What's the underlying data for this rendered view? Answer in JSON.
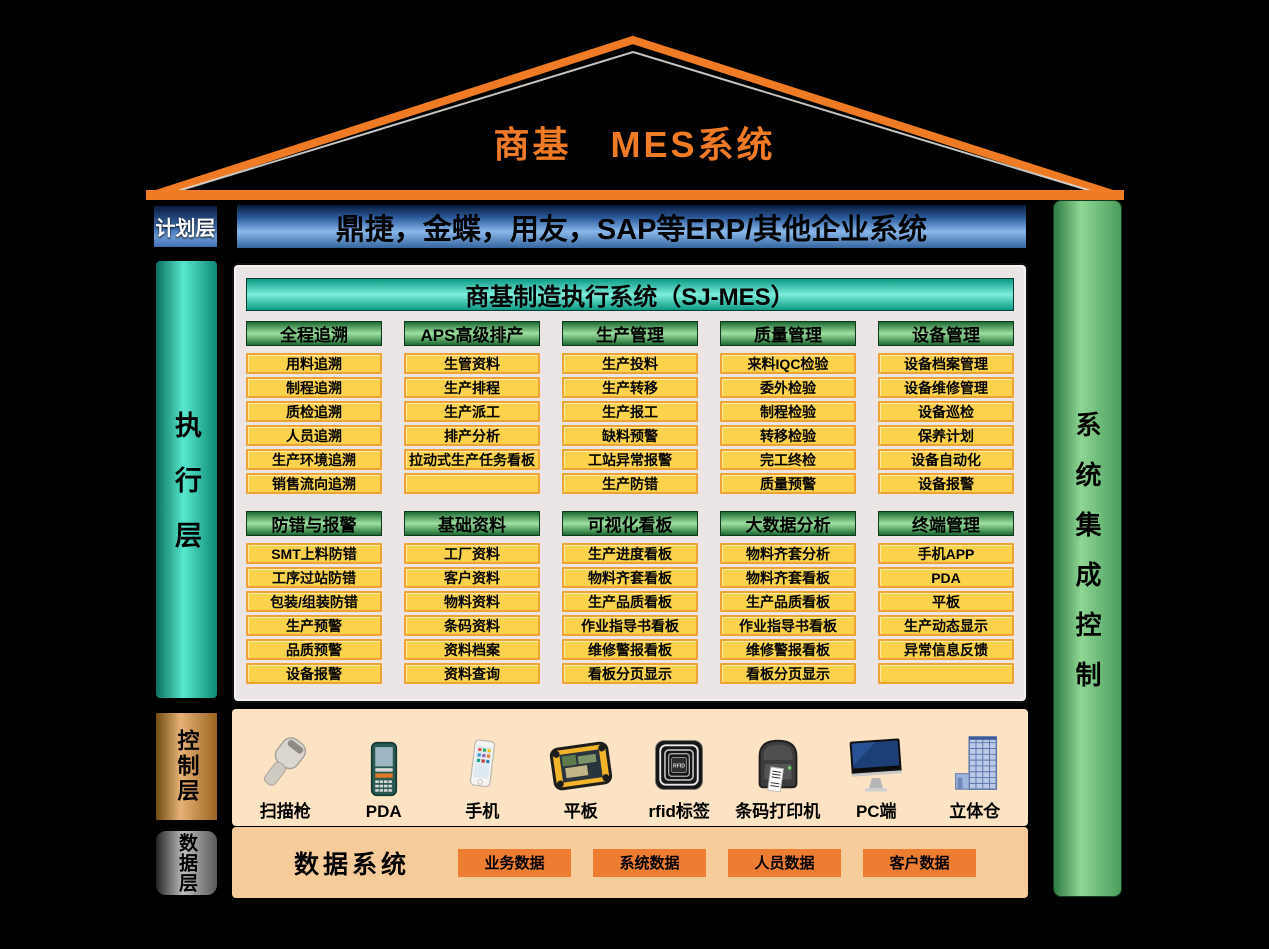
{
  "roof": {
    "title": "商基　MES系统"
  },
  "plan_layer": {
    "label": "计划层",
    "erp_bar": "鼎捷，金蝶，用友，SAP等ERP/其他企业系统"
  },
  "exec_layer": {
    "label": "执行层"
  },
  "control_layer": {
    "label": "控制层",
    "devices": [
      {
        "icon": "barcode-scanner-icon",
        "label": "扫描枪"
      },
      {
        "icon": "pda-icon",
        "label": "PDA"
      },
      {
        "icon": "phone-icon",
        "label": "手机"
      },
      {
        "icon": "tablet-icon",
        "label": "平板"
      },
      {
        "icon": "rfid-tag-icon",
        "label": "rfid标签"
      },
      {
        "icon": "barcode-printer-icon",
        "label": "条码打印机"
      },
      {
        "icon": "pc-monitor-icon",
        "label": "PC端"
      },
      {
        "icon": "warehouse-icon",
        "label": "立体仓"
      }
    ]
  },
  "data_layer": {
    "label": "数据层",
    "title": "数据系统",
    "boxes": [
      "业务数据",
      "系统数据",
      "人员数据",
      "客户数据"
    ]
  },
  "integration_bar": {
    "label": "系统集成控制"
  },
  "mes": {
    "header": "商基制造执行系统（SJ-MES）",
    "groups_row1": [
      {
        "title": "全程追溯",
        "items": [
          "用料追溯",
          "制程追溯",
          "质检追溯",
          "人员追溯",
          "生产环境追溯",
          "销售流向追溯"
        ]
      },
      {
        "title": "APS高级排产",
        "items": [
          "生管资料",
          "生产排程",
          "生产派工",
          "排产分析",
          "拉动式生产任务看板",
          ""
        ]
      },
      {
        "title": "生产管理",
        "items": [
          "生产投料",
          "生产转移",
          "生产报工",
          "缺料预警",
          "工站异常报警",
          "生产防错"
        ]
      },
      {
        "title": "质量管理",
        "items": [
          "来料IQC检验",
          "委外检验",
          "制程检验",
          "转移检验",
          "完工终检",
          "质量预警"
        ]
      },
      {
        "title": "设备管理",
        "items": [
          "设备档案管理",
          "设备维修管理",
          "设备巡检",
          "保养计划",
          "设备自动化",
          "设备报警"
        ]
      }
    ],
    "groups_row2": [
      {
        "title": "防错与报警",
        "items": [
          "SMT上料防错",
          "工序过站防错",
          "包装/组装防错",
          "生产预警",
          "品质预警",
          "设备报警"
        ]
      },
      {
        "title": "基础资料",
        "items": [
          "工厂资料",
          "客户资料",
          "物料资料",
          "条码资料",
          "资料档案",
          "资料查询"
        ]
      },
      {
        "title": "可视化看板",
        "items": [
          "生产进度看板",
          "物料齐套看板",
          "生产品质看板",
          "作业指导书看板",
          "维修警报看板",
          "看板分页显示"
        ]
      },
      {
        "title": "大数据分析",
        "items": [
          "物料齐套分析",
          "物料齐套看板",
          "生产品质看板",
          "作业指导书看板",
          "维修警报看板",
          "看板分页显示"
        ]
      },
      {
        "title": "终端管理",
        "items": [
          "手机APP",
          "PDA",
          "平板",
          "生产动态显示",
          "异常信息反馈",
          ""
        ]
      }
    ]
  },
  "colors": {
    "roof_orange": "#F07B25",
    "erp_blue": "#2D5D9E",
    "mes_teal": "#18BFA4",
    "module_green": "#3E9E53",
    "item_yellow": "#FBD24B",
    "item_border_orange": "#F0A233",
    "integration_green": "#8FD794",
    "control_peach": "#FBE3C3",
    "data_peach": "#F6CC9A",
    "data_box_orange": "#ED7D31"
  }
}
